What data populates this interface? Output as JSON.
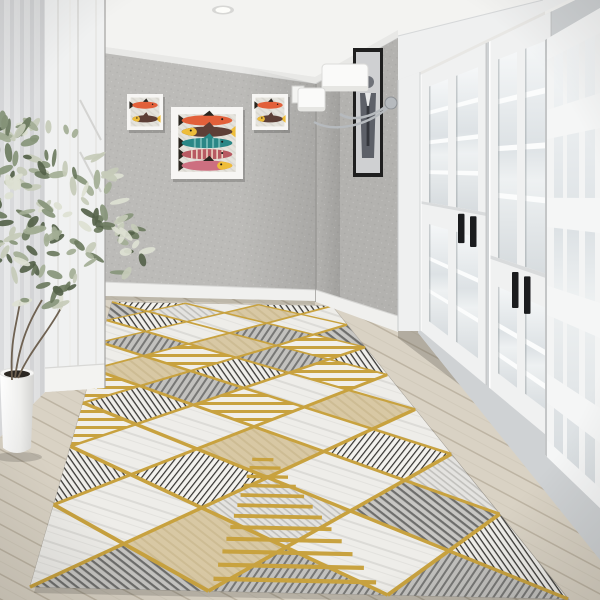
{
  "scene": {
    "description": "Bright hallway interior: geometric gold-and-grey runner rug, white glazed double doors with black recessed handles, grey stucco walls with three fish art prints, black portrait frame, chrome two-shade wall sconce, recessed ceiling light, striped panel wall, potted sage plant in white cylinder pot, light oak plank floor",
    "style": "product-photo"
  },
  "colors": {
    "gold": "#c8a23f",
    "goldLight": "#e2c06d",
    "rugBase": "#ecebe7",
    "rugShadow": "#8a867c",
    "wallBack": "#bcbbb8",
    "wallRight": "#b3b2af",
    "wallShade": "#a19f9c",
    "ceiling": "#f3f3f1",
    "crown": "#e8e8e6",
    "baseboard": "#f0f0ee",
    "floorWood": "#d9d2c4",
    "floorSeam": "#bdb4a3",
    "floorDark": "#b7ae9d",
    "doorWhite": "#f0f1f1",
    "doorShade": "#d8dadb",
    "frameWhite": "#eff0f0",
    "glassHi": "#f5f7f8",
    "glassLo": "#d7dcdf",
    "handle": "#1b1c1e",
    "stripeA": "#e9eaeb",
    "stripeB": "#dbdcde",
    "pot": "#f7f7f6",
    "potShade": "#d9d9d7",
    "soil": "#2b2722",
    "artFrame": "#f7f6f4",
    "artBg": "#e6e3da",
    "portraitFrame": "#1f1f1f",
    "portraitBg": "#cfd0d2",
    "portraitFig": "#5d6068",
    "chrome": "#b6babe",
    "sconceShade": "#fafaf9",
    "fishOrange": "#e2603a",
    "fishBlack": "#29251f",
    "fishBrown": "#5d3f37",
    "fishYellow": "#eebd3a",
    "fishTeal": "#2a8786",
    "fishMaroon": "#b85a62",
    "fishCream": "#f3e8d2",
    "fishPink": "#cd6f80",
    "stem": "#6f6252"
  },
  "ceiling": {
    "light": "recessed-round",
    "light_pos": [
      223,
      10
    ]
  },
  "wall_art": {
    "left_small_frame": {
      "x": 127,
      "y": 94,
      "w": 36,
      "h": 36,
      "fish": [
        "orange",
        "brownyellow"
      ]
    },
    "center_frame": {
      "x": 171,
      "y": 107,
      "w": 72,
      "h": 72,
      "fish": [
        "orange",
        "brownyellow",
        "teal",
        "maroonstripe",
        "pinkyellow"
      ]
    },
    "right_small_frame": {
      "x": 252,
      "y": 94,
      "w": 36,
      "h": 36,
      "fish": [
        "orange",
        "brownyellow"
      ]
    },
    "portrait_frame": {
      "x": 353,
      "y": 48,
      "w": 30,
      "h": 129,
      "subject": "abstract figure sketch"
    }
  },
  "light_switch": {
    "x": 292,
    "y": 86,
    "w": 12,
    "h": 17
  },
  "sconce": {
    "shades": 2,
    "finish": "chrome",
    "plate": [
      390,
      102
    ]
  },
  "doors": {
    "leaves": 2,
    "glass_columns_per_leaf": 2,
    "handle_pairs": [
      {
        "x": [
          458,
          470
        ],
        "t": 0.52
      },
      {
        "x": [
          512,
          524
        ],
        "t": 0.645
      }
    ],
    "side_panel": true
  },
  "rug": {
    "columns": 3,
    "rows": 7,
    "corners": {
      "nl": [
        30,
        587
      ],
      "nr": [
        568,
        599
      ],
      "fl": [
        112,
        302
      ],
      "fr": [
        332,
        306
      ]
    },
    "fill_sequence": [
      "marble",
      "hatchA",
      "blackB",
      "marble",
      "beige",
      "hatchB",
      "goldbars",
      "marble",
      "blackA",
      "light",
      "marble",
      "hatchB",
      "goldbars",
      "blackB",
      "marble",
      "beige"
    ],
    "ladder_bars": 12
  },
  "plant": {
    "leaf_colors": [
      "#55624a",
      "#6d7b60",
      "#87957a",
      "#a3ae95",
      "#c6cbb9",
      "#dde1d3"
    ],
    "pot": "white-cylinder"
  },
  "floor": {
    "material": "light oak planks",
    "angle_deg": 28
  }
}
